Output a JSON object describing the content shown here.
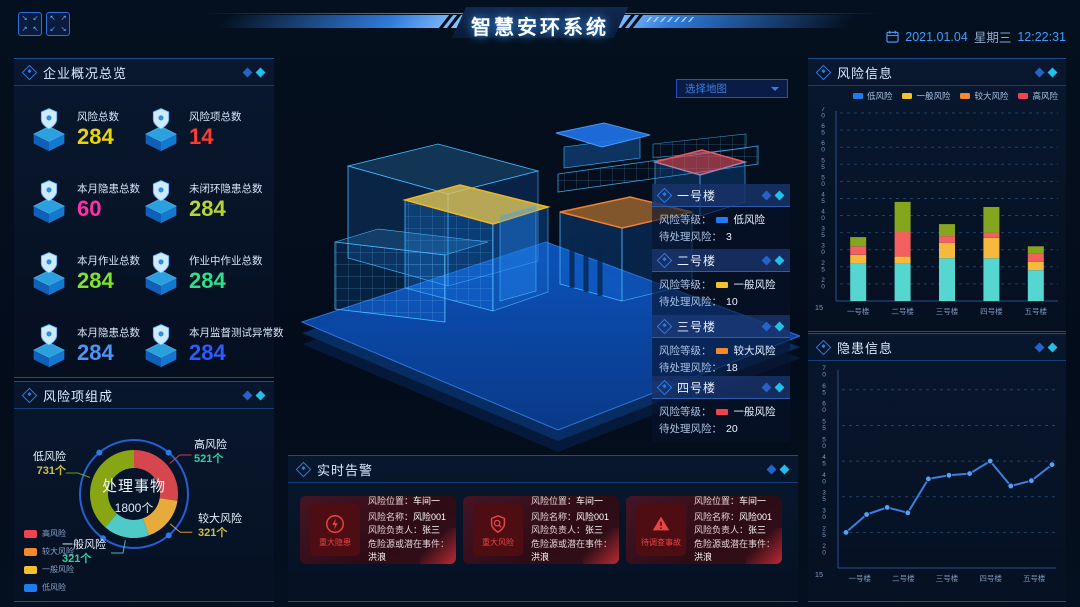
{
  "header": {
    "title": "智慧安环系统",
    "date": "2021.01.04",
    "weekday": "星期三",
    "time": "12:22:31"
  },
  "overview": {
    "title": "企业概况总览",
    "stats": [
      {
        "label": "风险总数",
        "value": "284",
        "color": "#e9d408"
      },
      {
        "label": "风险项总数",
        "value": "14",
        "color": "#ff3b30"
      },
      {
        "label": "本月隐患总数",
        "value": "60",
        "color": "#ff2fa8"
      },
      {
        "label": "未闭环隐患总数",
        "value": "284",
        "color": "#b8d333"
      },
      {
        "label": "本月作业总数",
        "value": "284",
        "color": "#7fe32a"
      },
      {
        "label": "作业中作业总数",
        "value": "284",
        "color": "#2de089"
      },
      {
        "label": "本月隐患总数",
        "value": "284",
        "color": "#4f93f5"
      },
      {
        "label": "本月监督测试异常数",
        "value": "284",
        "color": "#2e5bff"
      }
    ]
  },
  "map": {
    "placeholder": "选择地图"
  },
  "buildings": {
    "labels": {
      "level": "风险等级：",
      "pending": "待处理风险："
    },
    "cards": [
      {
        "name": "一号楼",
        "level": "低风险",
        "level_color": "#1f7bf0",
        "pending": "3"
      },
      {
        "name": "二号楼",
        "level": "一般风险",
        "level_color": "#f2c12e",
        "pending": "10"
      },
      {
        "name": "三号楼",
        "level": "较大风险",
        "level_color": "#f28a2c",
        "pending": "18"
      },
      {
        "name": "四号楼",
        "level": "一般风险",
        "level_color": "#ef4450",
        "pending": "20"
      }
    ]
  },
  "alerts": {
    "title": "实时告警",
    "items": [
      {
        "badge": "重大隐患",
        "icon": "lightning-circle-icon",
        "rows": [
          {
            "label": "风险位置：",
            "value": "车间一"
          },
          {
            "label": "风险名称：",
            "value": "风险001"
          },
          {
            "label": "风险负责人：",
            "value": "张三"
          },
          {
            "label": "危险源或潜在事件：",
            "value": "洪浪"
          }
        ]
      },
      {
        "badge": "重大风险",
        "icon": "shield-scan-icon",
        "rows": [
          {
            "label": "风险位置：",
            "value": "车间一"
          },
          {
            "label": "风险名称：",
            "value": "风险001"
          },
          {
            "label": "风险负责人：",
            "value": "张三"
          },
          {
            "label": "危险源或潜在事件：",
            "value": "洪浪"
          }
        ]
      },
      {
        "badge": "待调查事故",
        "icon": "warning-triangle-icon",
        "rows": [
          {
            "label": "风险位置：",
            "value": "车间一"
          },
          {
            "label": "风险名称：",
            "value": "风险001"
          },
          {
            "label": "风险负责人：",
            "value": "张三"
          },
          {
            "label": "危险源或潜在事件：",
            "value": "洪浪"
          }
        ]
      }
    ]
  },
  "risk_info": {
    "title": "风险信息"
  },
  "danger_info": {
    "title": "隐患信息"
  },
  "chart_data": [
    {
      "type": "pie",
      "title": "风险项组成",
      "center_label": "处理事物",
      "center_value": "1800个",
      "slices": [
        {
          "name": "高风险",
          "value": 521,
          "display": "521个",
          "color": "#e0494f",
          "value_color": "#2fd3a2"
        },
        {
          "name": "较大风险",
          "value": 321,
          "display": "321个",
          "color": "#f2b43c",
          "value_color": "#cfc03a"
        },
        {
          "name": "一般风险",
          "value": 321,
          "display": "321个",
          "color": "#52d5cf",
          "value_color": "#2fd3a2"
        },
        {
          "name": "低风险",
          "value": 731,
          "display": "731个",
          "color": "#8fae12",
          "value_color": "#cfc03a"
        }
      ],
      "legend": [
        {
          "label": "高风险",
          "color": "#ef4450"
        },
        {
          "label": "较大风险",
          "color": "#f28a2c"
        },
        {
          "label": "一般风险",
          "color": "#f2c12e"
        },
        {
          "label": "低风险",
          "color": "#1f7bf0"
        }
      ],
      "legend_position": "bottom-left"
    },
    {
      "type": "bar",
      "stacked": true,
      "title": "风险信息",
      "categories": [
        "一号楼",
        "二号楼",
        "三号楼",
        "四号楼",
        "五号楼"
      ],
      "series": [
        {
          "name": "低风险",
          "color": "#56d6d0",
          "values": [
            11,
            11,
            12.5,
            12.5,
            9
          ]
        },
        {
          "name": "一般风险",
          "color": "#f6b93d",
          "values": [
            2.5,
            2,
            4.5,
            6,
            2.5
          ]
        },
        {
          "name": "较大风险",
          "color": "#f26060",
          "values": [
            2.5,
            7.5,
            2,
            1.5,
            2.5
          ]
        },
        {
          "name": "高风险",
          "color": "#86a51f",
          "values": [
            2.7,
            8.5,
            3.5,
            7.5,
            2
          ]
        }
      ],
      "legend": [
        {
          "label": "低风险",
          "color": "#1f7bf0"
        },
        {
          "label": "一般风险",
          "color": "#f2c12e"
        },
        {
          "label": "较大风险",
          "color": "#f28a2c"
        },
        {
          "label": "高风险",
          "color": "#ef4450"
        }
      ],
      "ylim": [
        15,
        70
      ],
      "ytick_step": 5,
      "baseline_label": "15",
      "grid": "dashed",
      "legend_position": "top-right"
    },
    {
      "type": "line",
      "title": "隐患信息",
      "categories": [
        "一号楼",
        "二号楼",
        "三号楼",
        "四号楼",
        "五号楼"
      ],
      "values": [
        25,
        30,
        32,
        30.5,
        40,
        41,
        41.5,
        45,
        38,
        39.5,
        44
      ],
      "color": "#3f7de0",
      "point_color": "#5aa0f0",
      "ylim": [
        15,
        70
      ],
      "ytick_step": 5,
      "baseline_label": "15",
      "grid": "dashed"
    }
  ]
}
